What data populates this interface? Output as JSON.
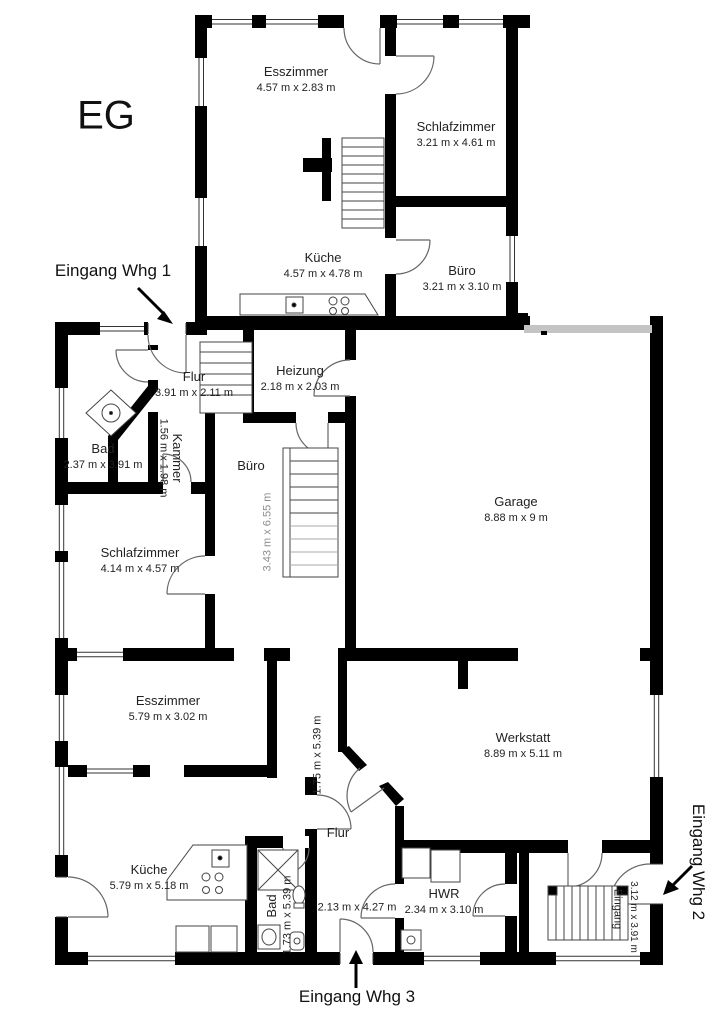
{
  "floor_plan": {
    "floor_label": "EG",
    "colors": {
      "wall": "#000000",
      "opening_band": "#c4c4c4",
      "muted_dims": "#8d8d8d"
    },
    "entrances": {
      "whg1": "Eingang Whg 1",
      "whg2": "Eingang Whg 2",
      "whg3": "Eingang Whg 3"
    },
    "upper_unit": {
      "esszimmer": {
        "name": "Esszimmer",
        "dims": "4.57 m x 2.83 m"
      },
      "schlafzimmer": {
        "name": "Schlafzimmer",
        "dims": "3.21 m x 4.61 m"
      },
      "kueche": {
        "name": "Küche",
        "dims": "4.57 m x 4.78 m"
      },
      "buero": {
        "name": "Büro",
        "dims": "3.21 m x 3.10 m"
      }
    },
    "ground_unit": {
      "flur": {
        "name": "Flur",
        "dims": "3.91 m x 2.11 m"
      },
      "heizung": {
        "name": "Heizung",
        "dims": "2.18 m x 2.03 m"
      },
      "bad": {
        "name": "Bad",
        "dims": "2.37 m x 3.91 m"
      },
      "kammer": {
        "name": "Kammer",
        "dims": "1.56 m x 1.98 m"
      },
      "buero": {
        "name": "Büro",
        "dims": "3.43 m x 6.55 m"
      },
      "schlafzimmer": {
        "name": "Schlafzimmer",
        "dims": "4.14 m x 4.57 m"
      },
      "garage": {
        "name": "Garage",
        "dims": "8.88 m x 9 m"
      },
      "esszimmer": {
        "name": "Esszimmer",
        "dims": "5.79 m x 3.02 m"
      },
      "werkstatt": {
        "name": "Werkstatt",
        "dims": "8.89 m x 5.11 m"
      },
      "kueche": {
        "name": "Küche",
        "dims": "5.79 m x 5.18 m"
      },
      "bad_unten": {
        "name": "Bad",
        "dims": "1.73 m x 5.39 m"
      },
      "flur_mitte": {
        "name": "Flur",
        "dims_vertical": "1.75 m x 5.39 m",
        "dims_horizontal": "2.13 m x 4.27 m"
      },
      "hwr": {
        "name": "HWR",
        "dims": "2.34 m x 3.10 m"
      },
      "eingang": {
        "name": "Eingang",
        "dims": "3.12 m x 3.91 m"
      }
    }
  }
}
